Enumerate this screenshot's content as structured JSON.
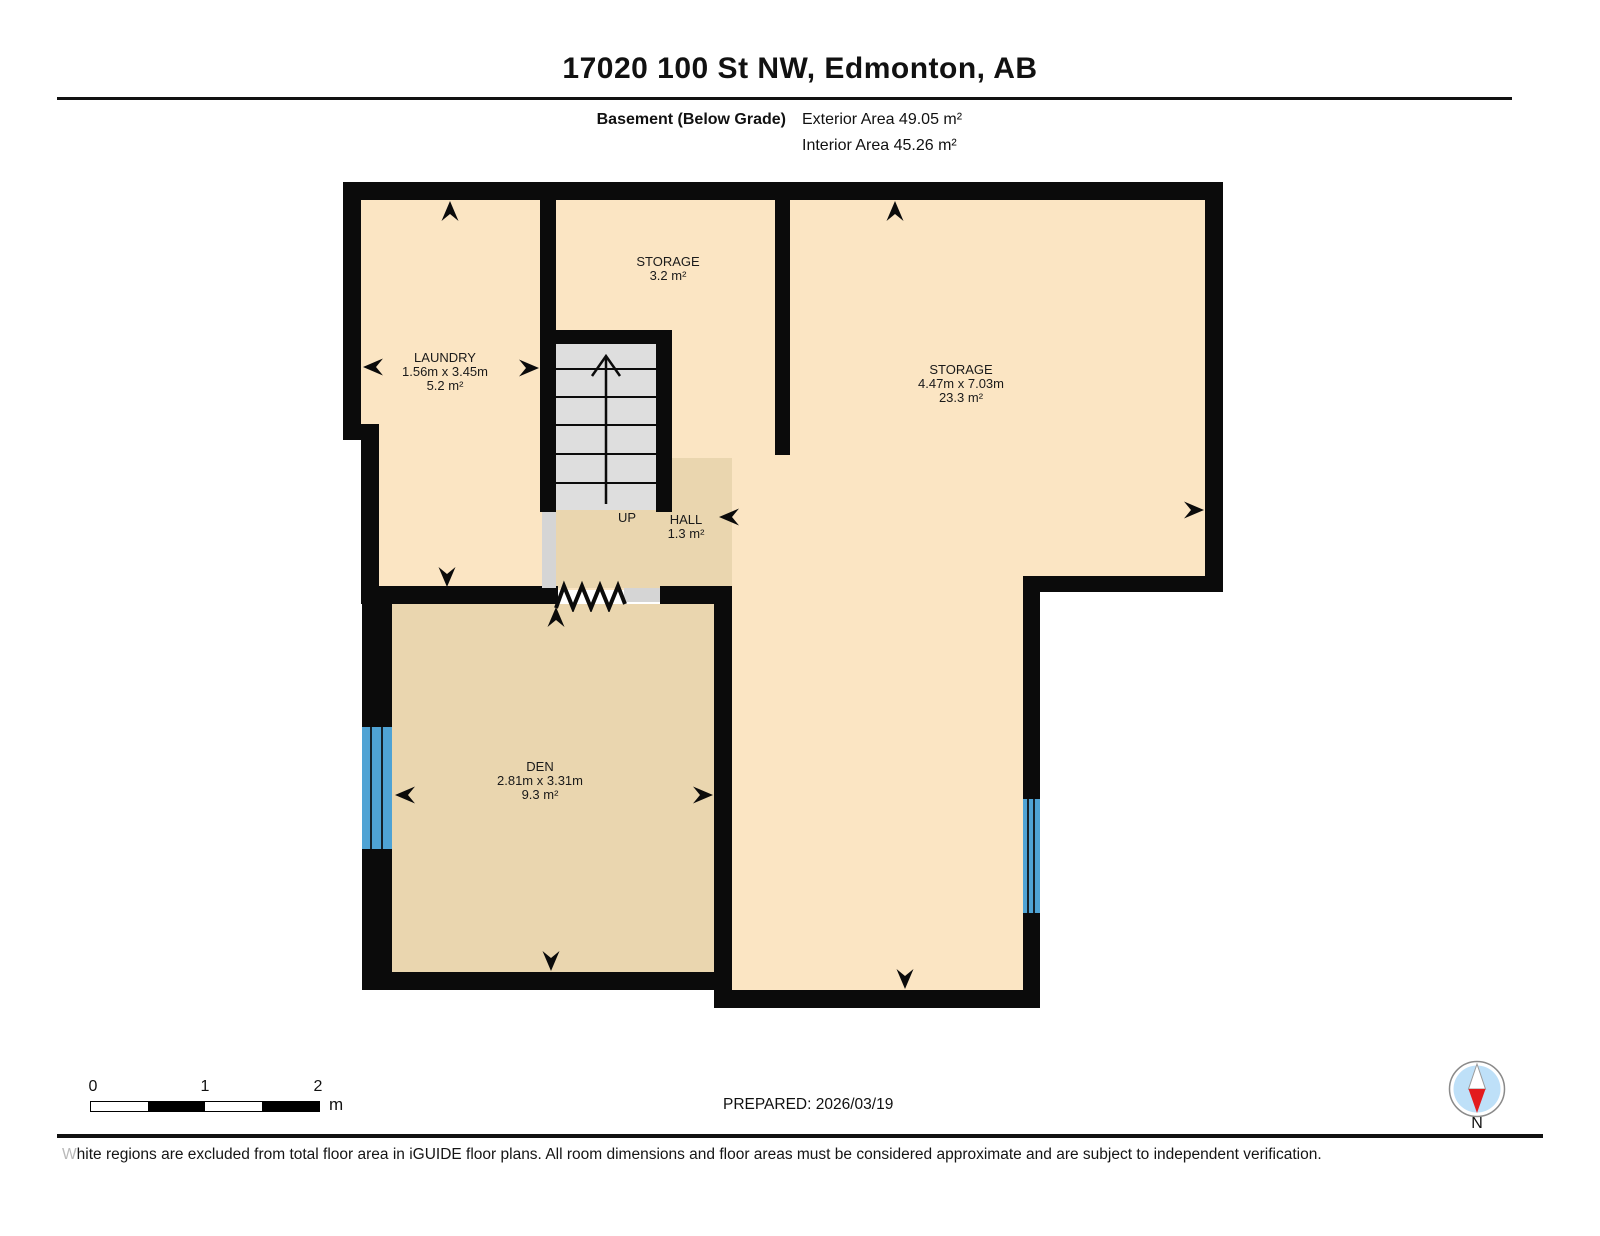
{
  "header": {
    "title": "17020 100 St NW, Edmonton, AB",
    "floor_label": "Basement (Below Grade)",
    "exterior_area": "Exterior Area 49.05 m²",
    "interior_area": "Interior Area 45.26 m²"
  },
  "rooms": {
    "laundry": {
      "name": "LAUNDRY",
      "dims": "1.56m x 3.45m",
      "area": "5.2 m²"
    },
    "storage_small": {
      "name": "STORAGE",
      "area": "3.2 m²"
    },
    "storage_large": {
      "name": "STORAGE",
      "dims": "4.47m x 7.03m",
      "area": "23.3 m²"
    },
    "hall": {
      "name": "HALL",
      "area": "1.3 m²"
    },
    "den": {
      "name": "DEN",
      "dims": "2.81m x 3.31m",
      "area": "9.3 m²"
    }
  },
  "stairs": {
    "direction_label": "UP"
  },
  "scale_bar": {
    "ticks": [
      "0",
      "1",
      "2"
    ],
    "unit": "m"
  },
  "footer": {
    "prepared": "PREPARED: 2026/03/19",
    "compass_label": "N",
    "disclaimer": "White regions are excluded from total floor area in iGUIDE floor plans. All room dimensions and floor areas must be considered approximate and are subject to independent verification."
  },
  "colors": {
    "wall": "#0b0b0b",
    "floor_light": "#FBE5C3",
    "floor_dark": "#EAD6AF",
    "stair_gray": "#DEDEDE",
    "opening_gray": "#D5D5D5",
    "window_blue": "#4FA3D4",
    "compass_blue": "#BEE0F8",
    "compass_red": "#E31B1E"
  }
}
